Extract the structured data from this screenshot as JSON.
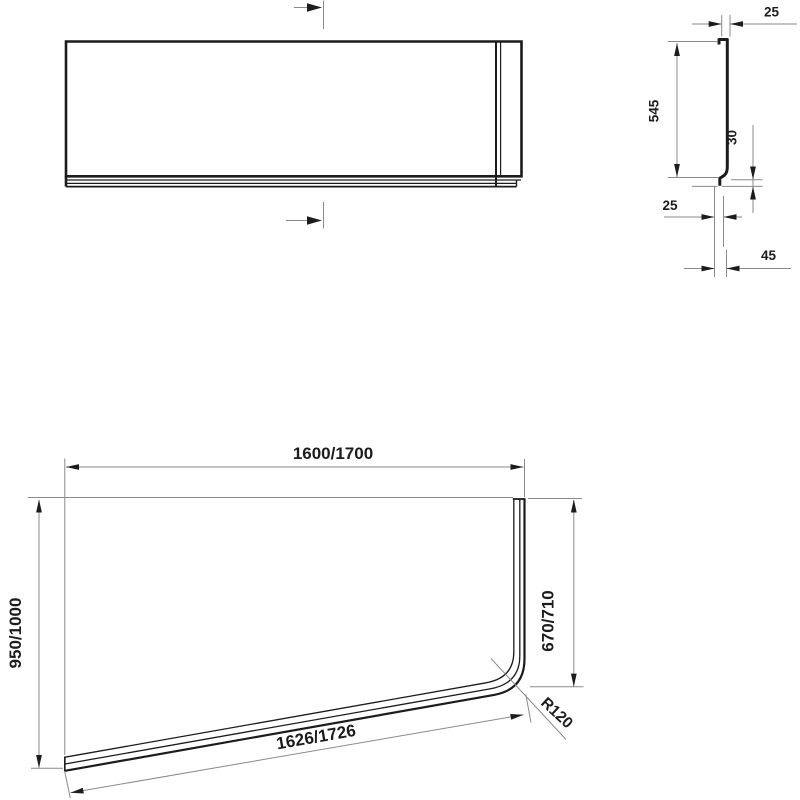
{
  "drawing_title": "Bath panel technical dimension drawing",
  "views": {
    "side_profile": {
      "top_width": "25",
      "panel_height": "545",
      "foot_height": "30",
      "foot_offset": "25",
      "foot_depth": "45"
    },
    "plan": {
      "overall_width": "1600/1700",
      "overall_depth": "950/1000",
      "side_length": "670/710",
      "front_edge_length": "1626/1726",
      "corner_radius": "R120"
    }
  },
  "colors": {
    "outline": "#1c1c1c",
    "dimension_lines": "#8a8a8a",
    "background": "#ffffff"
  }
}
